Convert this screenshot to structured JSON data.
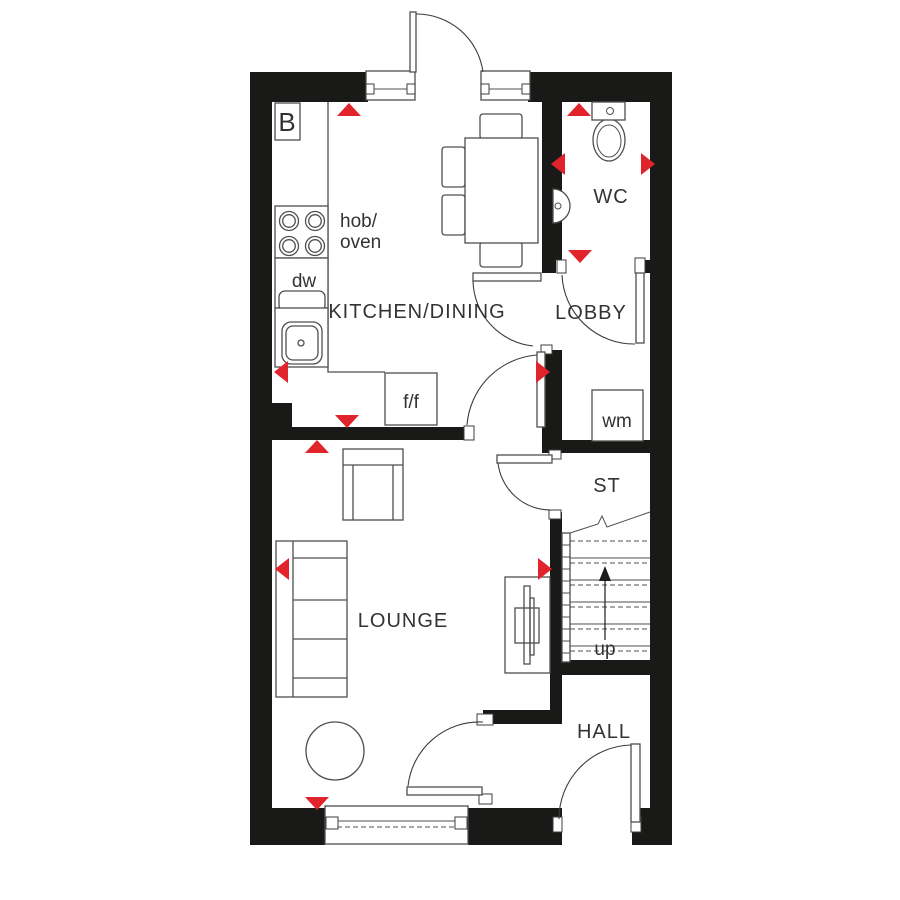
{
  "plan": {
    "type": "ground-floor-plan",
    "rooms": {
      "kitchen_dining": "KITCHEN/DINING",
      "lobby": "LOBBY",
      "wc": "WC",
      "lounge": "LOUNGE",
      "hall": "HALL",
      "store": "ST"
    },
    "labels": {
      "boiler": "B",
      "hob_line1": "hob/",
      "hob_line2": "oven",
      "dishwasher": "dw",
      "fridge_freezer": "f/f",
      "washing_machine": "wm",
      "stairs_up": "up"
    },
    "colors": {
      "background": "#ffffff",
      "wall": "#191917",
      "line": "#4f4f4f",
      "text": "#333333",
      "marker_red": "#e1232b"
    },
    "markers": [
      {
        "x": 349,
        "y": 103,
        "dir": "up"
      },
      {
        "x": 579,
        "y": 103,
        "dir": "up"
      },
      {
        "x": 551,
        "y": 164,
        "dir": "left"
      },
      {
        "x": 655,
        "y": 164,
        "dir": "right"
      },
      {
        "x": 580,
        "y": 263,
        "dir": "down"
      },
      {
        "x": 550,
        "y": 372,
        "dir": "right"
      },
      {
        "x": 274,
        "y": 372,
        "dir": "left"
      },
      {
        "x": 347,
        "y": 428,
        "dir": "down"
      },
      {
        "x": 317,
        "y": 440,
        "dir": "up"
      },
      {
        "x": 275,
        "y": 569,
        "dir": "left"
      },
      {
        "x": 552,
        "y": 569,
        "dir": "right"
      },
      {
        "x": 317,
        "y": 810,
        "dir": "down"
      }
    ]
  }
}
